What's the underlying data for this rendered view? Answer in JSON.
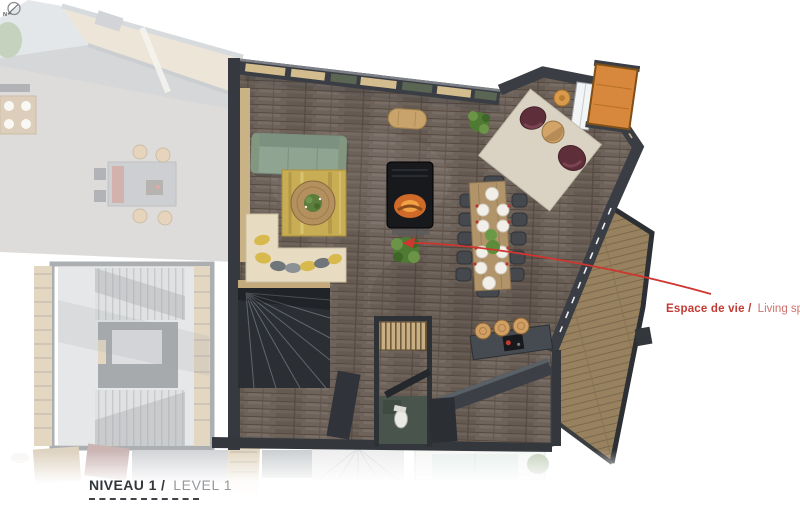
{
  "annotation": {
    "title_fr": "Espace de vie /",
    "title_en": "Living space",
    "leader_color": "#cf3630"
  },
  "level_label": {
    "fr": "NIVEAU 1 /",
    "en": "LEVEL 1",
    "north": "N"
  },
  "palette": {
    "background": "#ffffff",
    "floor_wood": "#6e635b",
    "floor_plank_line": "#57493f",
    "terrace_deck": "#97815f",
    "wall_dark": "#3a3e44",
    "window_frame_tan": "#d3bd8f",
    "window_glass_green": "#5a6553",
    "sofa_green": "#90a492",
    "rug_gold": "#c9ad55",
    "armchair_burgundy": "#5e2f3a",
    "armchair_rug_beige": "#dad3c3",
    "dining_table_wood": "#b1946a",
    "chair_gray": "#45494e",
    "fireplace_black": "#17191d",
    "fire_orange": "#e0762f",
    "balcony_orange": "#d8883c",
    "stool_tan": "#cf9f66",
    "accent_red": "#c23a32",
    "faded_neighbor_gray": "#b6b2ad"
  },
  "elements": [
    "main-living-floor",
    "terrace-deck",
    "top-window-wall",
    "green-sofa",
    "gold-area-rug",
    "round-coffee-table",
    "suspended-fireplace",
    "indoor-plant",
    "dining-table",
    "dining-chairs",
    "dinner-plates",
    "armchair-pair",
    "armchair-rug",
    "side-table",
    "window-seat-bench",
    "seat-pillows",
    "winder-stair",
    "kitchen-island",
    "bar-stools",
    "cooktop",
    "wc-toilet",
    "wardrobe-slats",
    "orange-balcony",
    "round-pouf",
    "neighbor-unit-roof",
    "neighbor-stairwell",
    "lower-level-roofs",
    "north-indicator",
    "leader-arrow"
  ]
}
